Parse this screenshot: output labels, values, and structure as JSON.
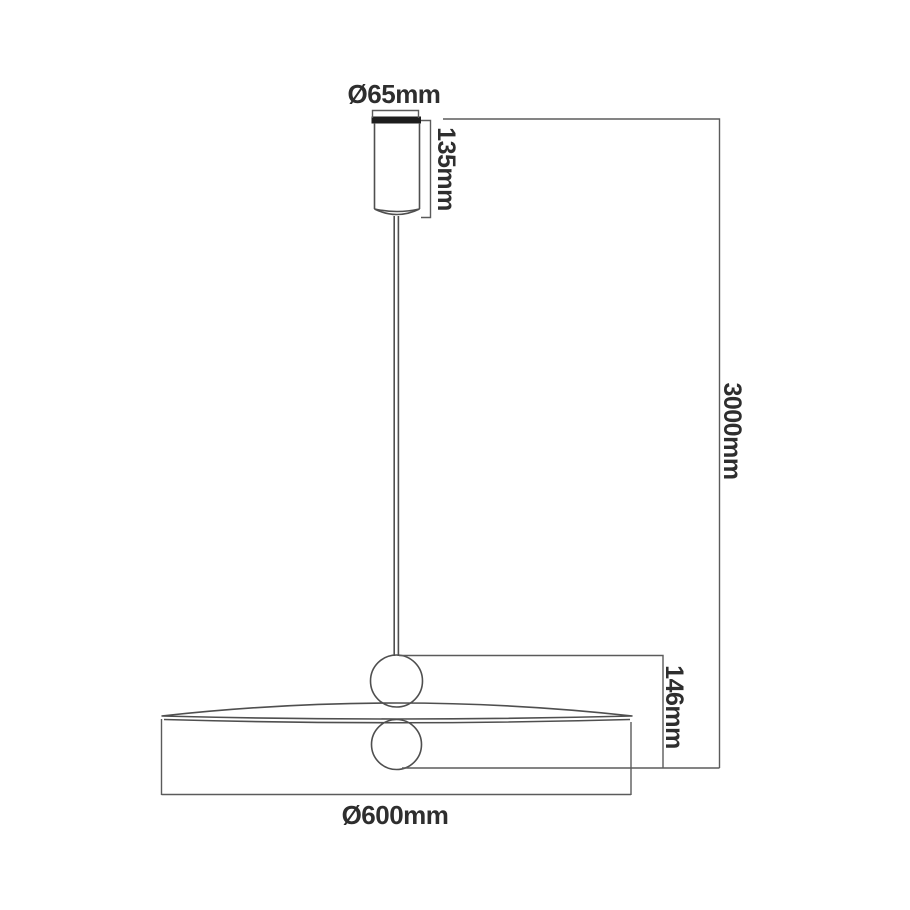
{
  "diagram": {
    "type": "technical-dimension-drawing",
    "subject": "pendant lamp line drawing with dimension callouts",
    "dimensions": {
      "canopy_diameter": "Ø65mm",
      "canopy_height": "135mm",
      "suspension_length": "3000mm",
      "fixture_height": "146mm",
      "shade_diameter": "Ø600mm"
    },
    "colors": {
      "background": "#ffffff",
      "outline": "#4f4f4f",
      "dimension_line": "#5b5b5b",
      "canopy_top_plate": "#1d1d1d",
      "text": "#2e2e2e"
    }
  }
}
